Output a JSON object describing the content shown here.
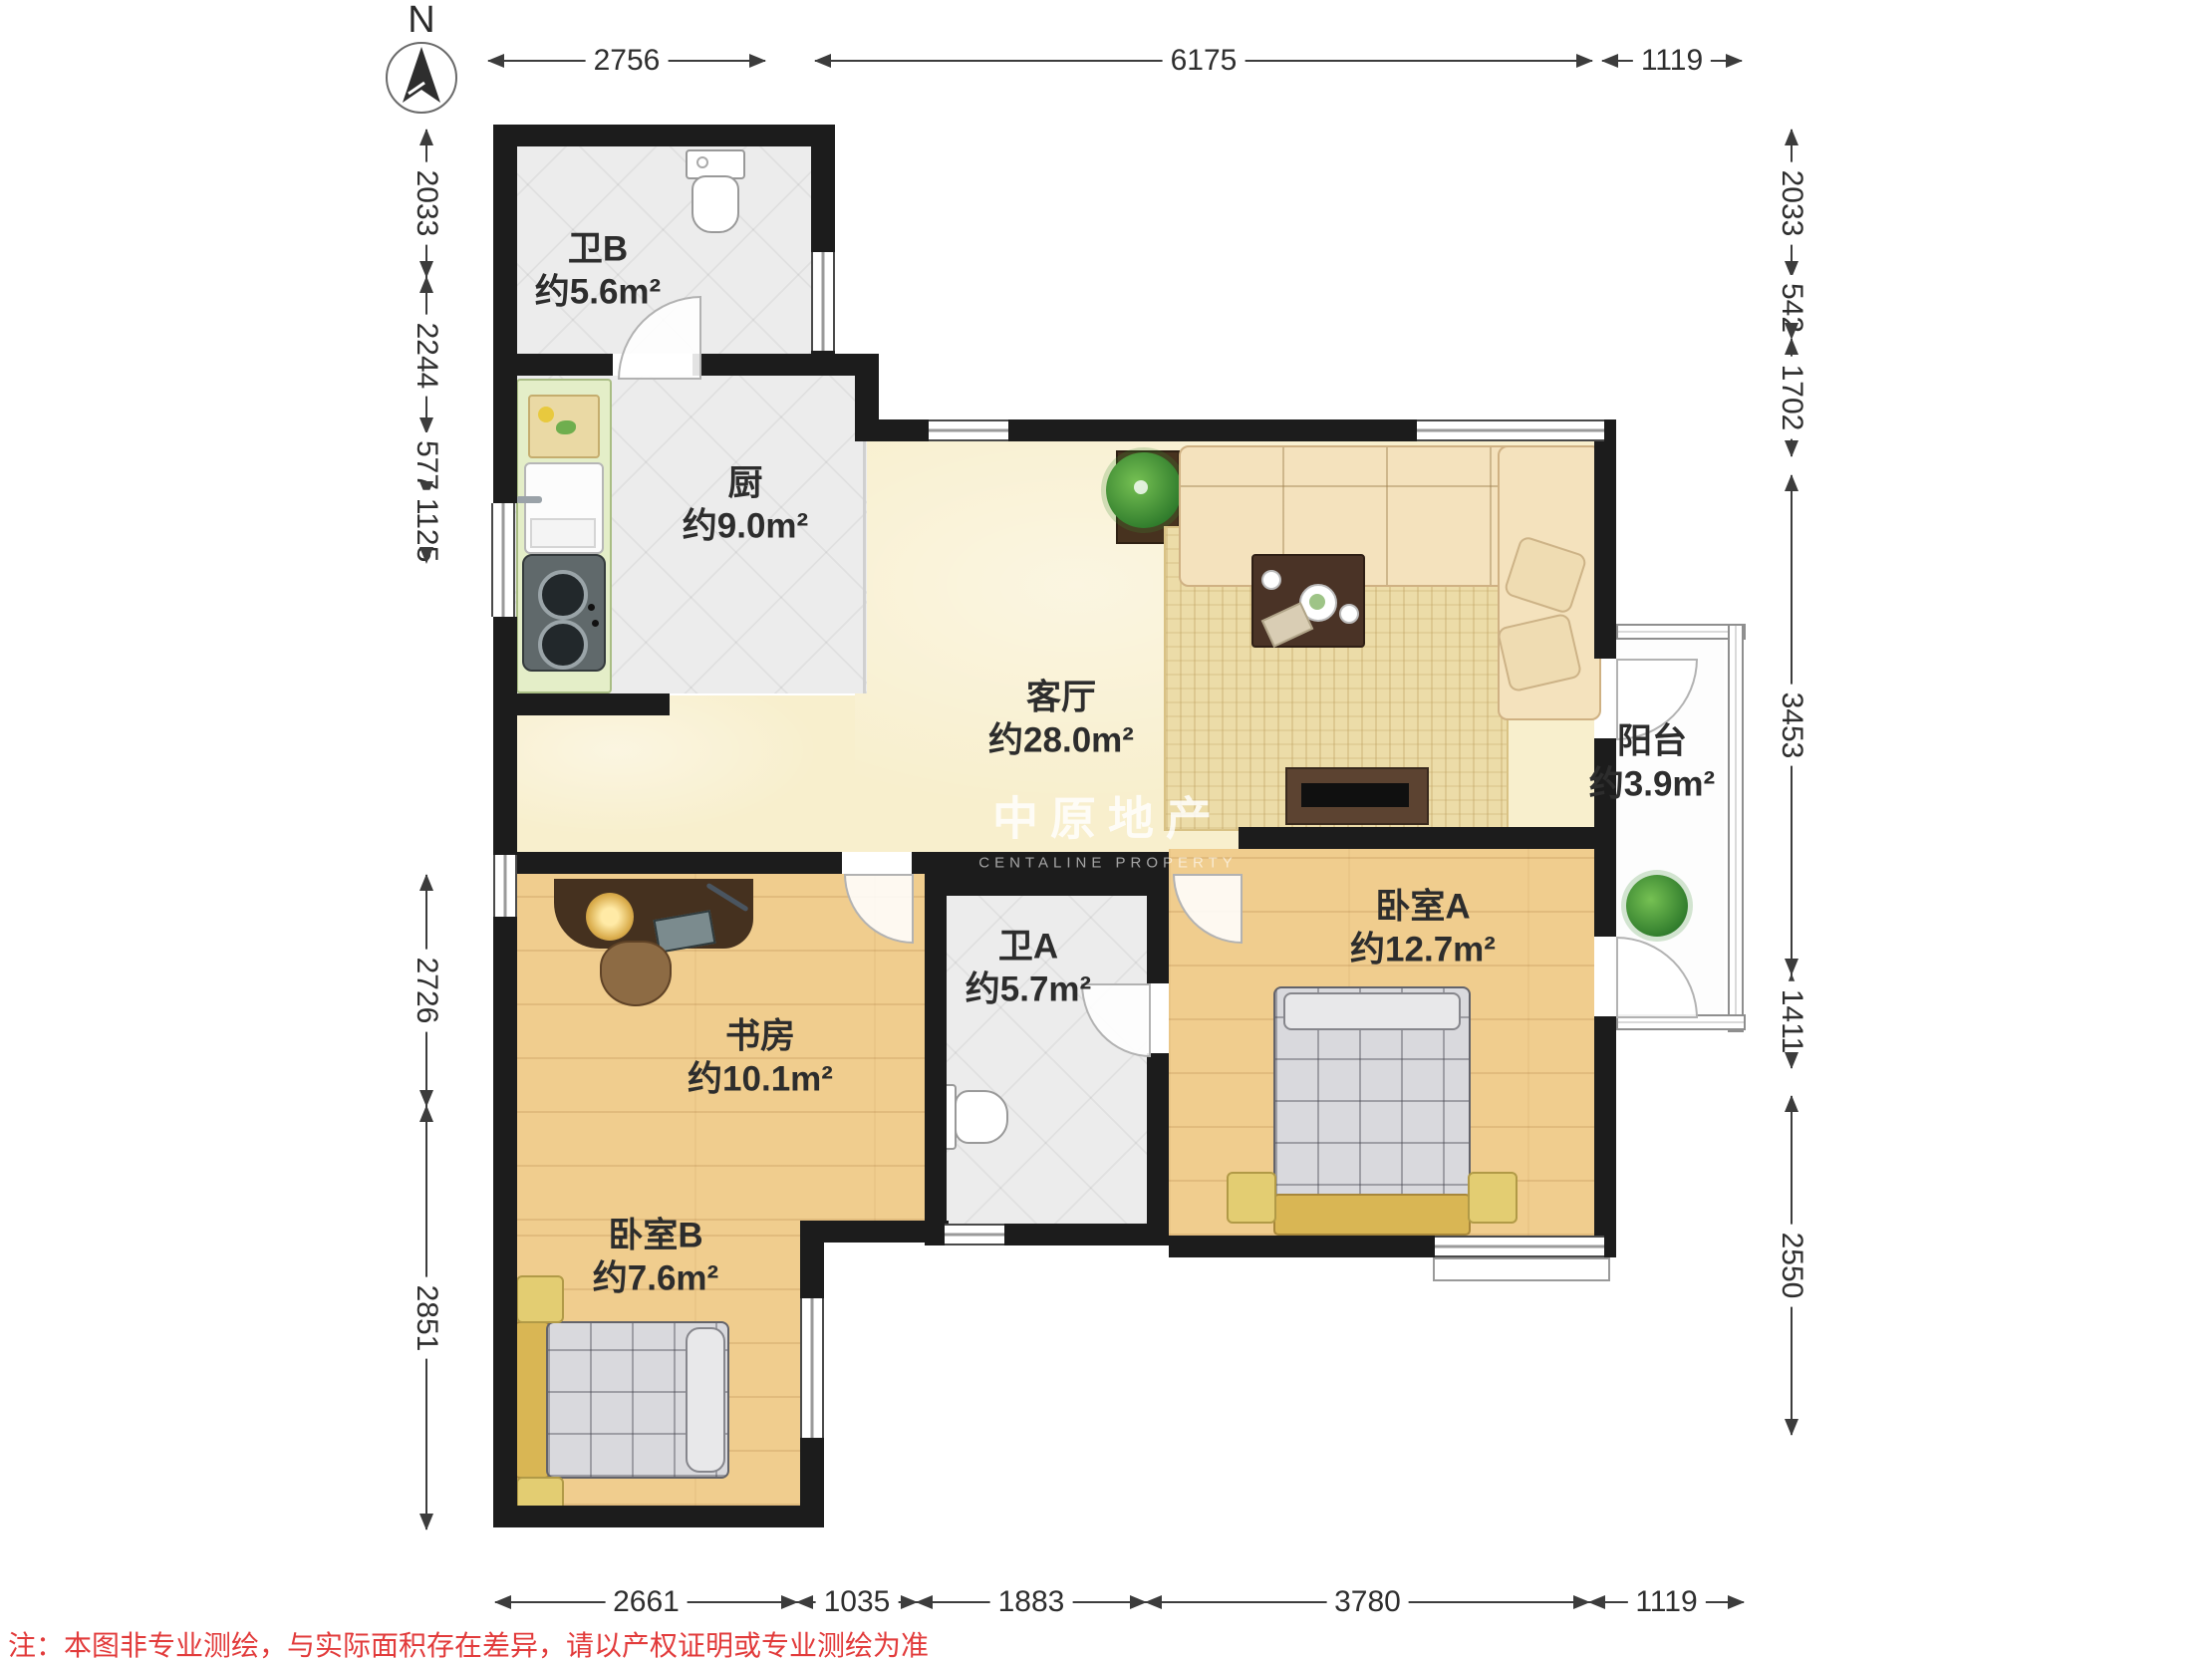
{
  "meta": {
    "compass_label": "N"
  },
  "watermark": {
    "cn": "中原地产",
    "en": "CENTALINE PROPERTY"
  },
  "note": "注：本图非专业测绘，与实际面积存在差异，请以产权证明或专业测绘为准",
  "rooms": {
    "bath_b": {
      "name": "卫B",
      "area": "约5.6m²"
    },
    "kitchen": {
      "name": "厨",
      "area": "约9.0m²"
    },
    "living": {
      "name": "客厅",
      "area": "约28.0m²"
    },
    "balcony": {
      "name": "阳台",
      "area": "约3.9m²"
    },
    "bath_a": {
      "name": "卫A",
      "area": "约5.7m²"
    },
    "study": {
      "name": "书房",
      "area": "约10.1m²"
    },
    "bedroom_a": {
      "name": "卧室A",
      "area": "约12.7m²"
    },
    "bedroom_b": {
      "name": "卧室B",
      "area": "约7.6m²"
    }
  },
  "dimensions": {
    "top": [
      "2756",
      "6175",
      "1119"
    ],
    "left": [
      "2033",
      "2244",
      "577",
      "1125",
      "2726",
      "2851"
    ],
    "right": [
      "2033",
      "542",
      "1702",
      "3453",
      "1411",
      "2550"
    ],
    "bottom": [
      "2661",
      "1035",
      "1883",
      "3780",
      "1119"
    ]
  },
  "colors": {
    "wall": "#1c1c1c",
    "wood_floor": "#f0cd8e",
    "tile_floor": "#ececec",
    "living_floor": "#f8efcd",
    "bed_frame": "#d9b654",
    "dimension_line": "#3c3c3c",
    "note_red": "#e23b3b"
  }
}
